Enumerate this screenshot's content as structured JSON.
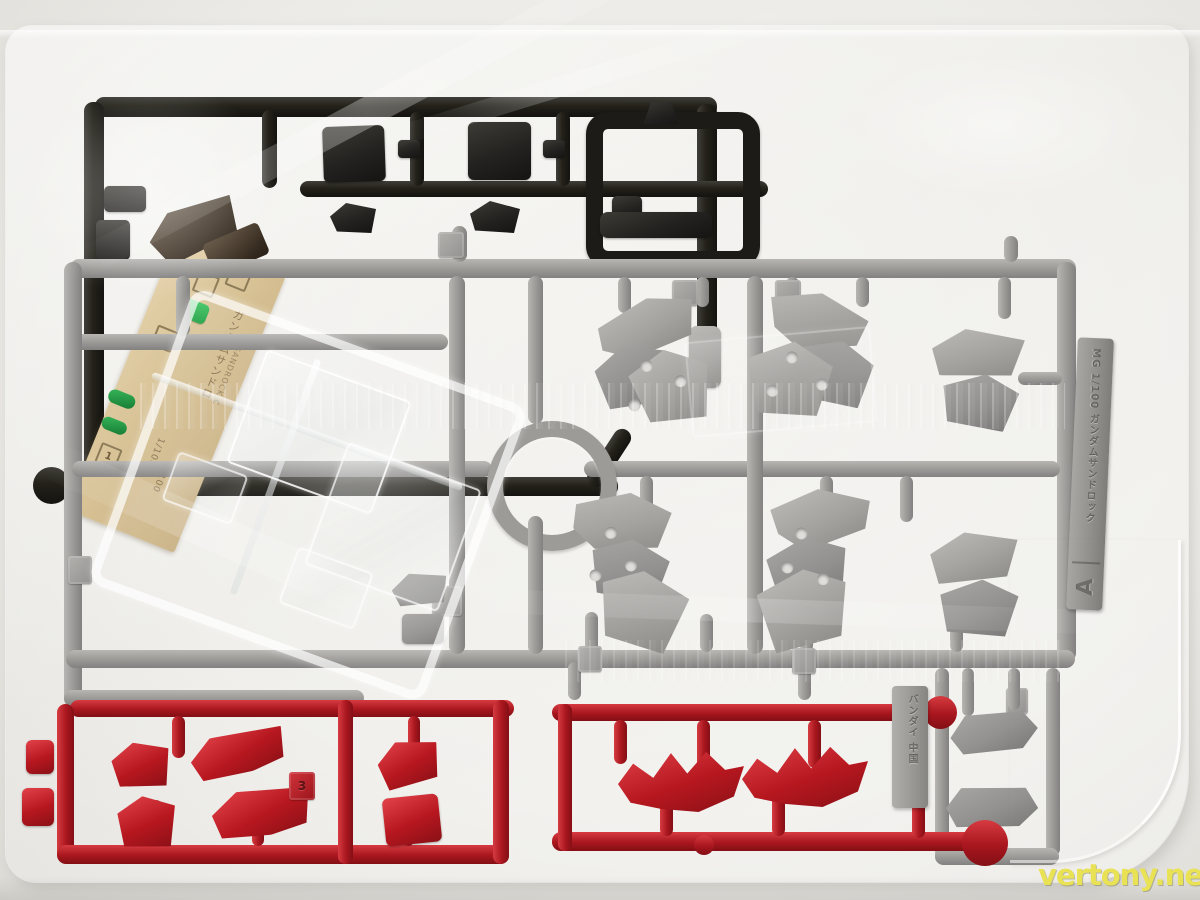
{
  "watermark": {
    "text": "vertony.net",
    "color": "#e9e255"
  },
  "sticker_sheet": {
    "title_vertical": "ガンダムサンドロ",
    "subtitle": "W SANDROCK C",
    "scale1": "1/100",
    "scale2": "1/100",
    "box_numbers": [
      "2",
      "1"
    ]
  },
  "runner_tags": {
    "letter": "A",
    "letter_tab_text": "MG 1/100 ガンダムサンドロック",
    "maker_tab_text": "バンダイ 中国"
  },
  "gate_numbers": {
    "red_runner": "3"
  },
  "colors": {
    "dark_runner": "#232119",
    "gray_runner": "#9c9b98",
    "red_runner": "#a9161e",
    "clear_parts": "#f3f6f6",
    "sticker_sheet": "#dbc79e",
    "foil_sticker_green": "#2fae4d",
    "bag_highlight": "#ffffff",
    "table": "#ecebe7"
  }
}
